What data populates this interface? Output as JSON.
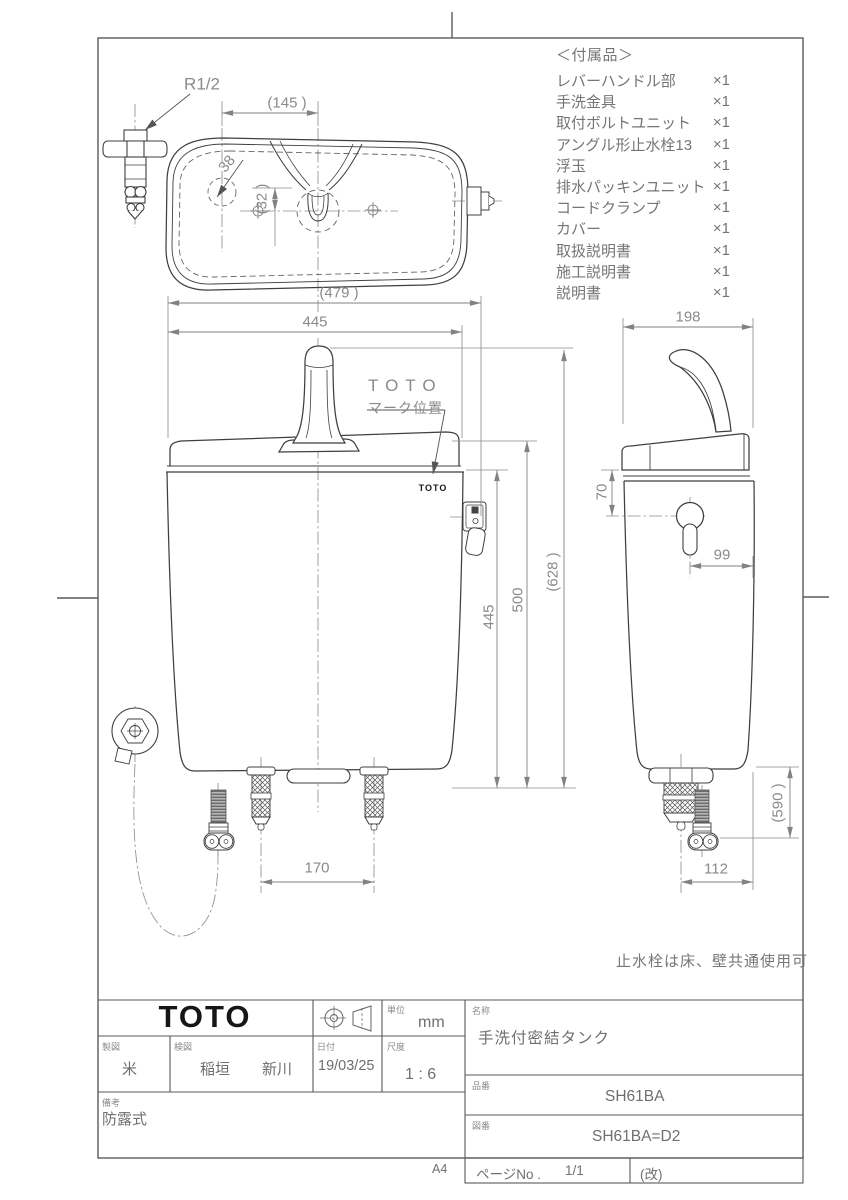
{
  "accessories": {
    "title": "＜付属品＞",
    "items": [
      {
        "name": "レバーハンドル部",
        "qty": "×1"
      },
      {
        "name": "手洗金具",
        "qty": "×1"
      },
      {
        "name": "取付ボルトユニット",
        "qty": "×1"
      },
      {
        "name": "アングル形止水栓13",
        "qty": "×1"
      },
      {
        "name": "浮玉",
        "qty": "×1"
      },
      {
        "name": "排水パッキンユニット",
        "qty": "×1"
      },
      {
        "name": "コードクランプ",
        "qty": "×1"
      },
      {
        "name": "カバー",
        "qty": "×1"
      },
      {
        "name": "取扱説明書",
        "qty": "×1"
      },
      {
        "name": "施工説明書",
        "qty": "×1"
      },
      {
        "name": "説明書",
        "qty": "×1"
      }
    ]
  },
  "dimensions": {
    "r12": "R1/2",
    "d145": "(145  )",
    "d38": "38",
    "d32": "(32 )",
    "d479": "(479  )",
    "d445w": "445",
    "d445h": "445",
    "d500": "500",
    "d628": "(628  )",
    "d198": "198",
    "d70": "70",
    "d99": "99",
    "d590": "(590 )",
    "d112": "112",
    "d170": "170"
  },
  "labels": {
    "mark_line1": "TOTO",
    "mark_line2": "マーク位置",
    "tank_logo": "TOTO",
    "note": "止水栓は床、壁共通使用可"
  },
  "titleblock": {
    "logo": "TOTO",
    "unit_label": "単位",
    "unit_value": "mm",
    "drafter_label": "製図",
    "drafter_value": "米",
    "checker_label": "検図",
    "checker_value1": "稲垣",
    "checker_value2": "新川",
    "date_label": "日付",
    "date_value": "19/03/25",
    "scale_label": "尺度",
    "scale_value": "1 : 6",
    "remarks_label": "備考",
    "remarks_value": "防露式",
    "name_label": "名称",
    "name_value": "手洗付密結タンク",
    "product_label": "品番",
    "product_value": "SH61BA",
    "drawing_label": "図番",
    "drawing_value": "SH61BA=D2",
    "page_label": "ページNo .",
    "page_value": "1/1",
    "rev_label": "(改)",
    "paper_size": "A4"
  }
}
